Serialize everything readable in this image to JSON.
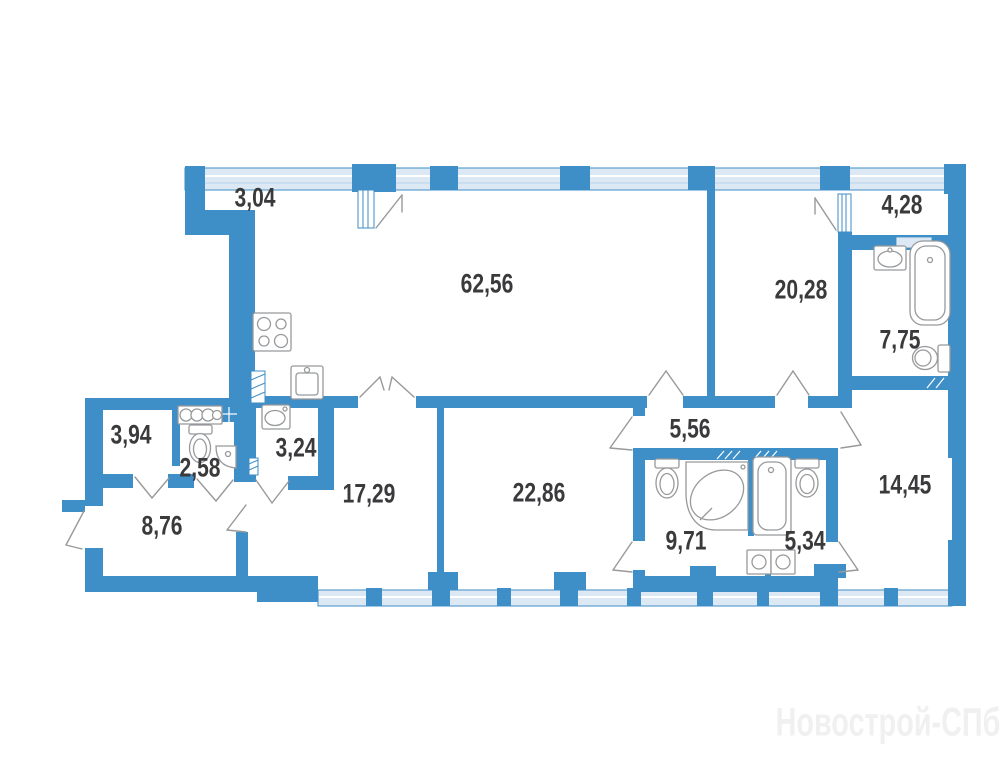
{
  "watermark": {
    "text": "Новострой-СПб",
    "color": "#f0f0f0"
  },
  "colors": {
    "wall": "#3E8EC7",
    "window_fill": "#DCE9F5",
    "fixture_stroke": "#97999B",
    "label_text": "#3A3A3C",
    "background": "#FFFFFF"
  },
  "rooms": {
    "balcony_left": {
      "area": "3,04"
    },
    "living_kitchen": {
      "area": "62,56"
    },
    "balcony_right": {
      "area": "4,28"
    },
    "bedroom_right": {
      "area": "20,28"
    },
    "bathroom_top_right": {
      "area": "7,75"
    },
    "storage_left": {
      "area": "3,94"
    },
    "wc_left": {
      "area": "2,58"
    },
    "utility_left": {
      "area": "3,24"
    },
    "inner_hall": {
      "area": "5,56"
    },
    "room_southwest": {
      "area": "17,29"
    },
    "room_south_center": {
      "area": "22,86"
    },
    "room_southeast": {
      "area": "14,45"
    },
    "entry_hall": {
      "area": "8,76"
    },
    "bathroom_main": {
      "area": "9,71"
    },
    "bathroom_small": {
      "area": "5,34"
    }
  },
  "icons": [
    "stove-icon",
    "kitchen-sink-icon",
    "vent-shaft-icon",
    "towel-radiator-icon",
    "toilet-icon",
    "corner-sink-icon",
    "washbasin-icon",
    "washing-machine-icon",
    "bathtub-icon",
    "corner-jacuzzi-icon",
    "door-swing-icon",
    "window-band",
    "entrance-door-icon"
  ]
}
